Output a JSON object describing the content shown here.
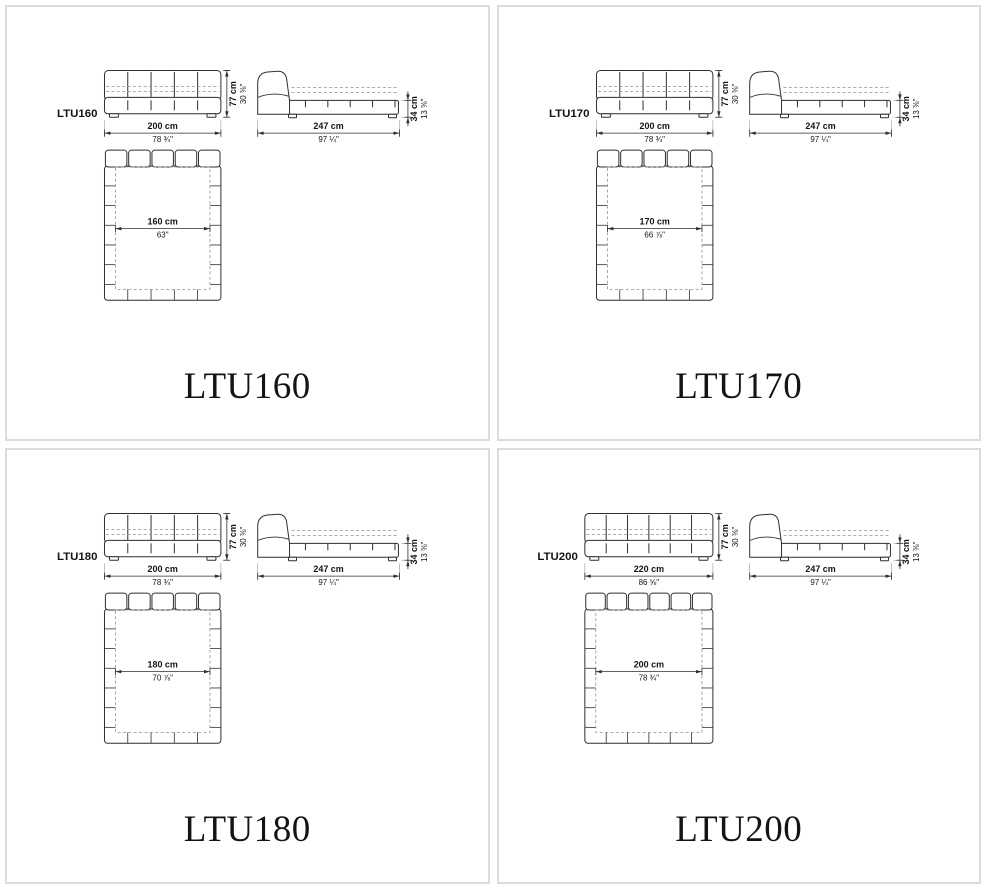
{
  "page": {
    "background": "#ffffff",
    "panel_border_color": "#dcdcdc",
    "line_color": "#2f2f2f",
    "dash_color": "#909090",
    "extension_color": "#9a9a9a",
    "text_color": "#141414"
  },
  "panels": [
    {
      "model": "LTU160",
      "title": "LTU160",
      "segments": 5,
      "front": {
        "width_cm": "200 cm",
        "width_in": "78 ¾\"",
        "height_cm": "77 cm",
        "height_in": "30 ⅜\""
      },
      "side": {
        "length_cm": "247 cm",
        "length_in": "97 ¼\"",
        "base_height_cm": "34 cm",
        "base_height_in": "13 ⅜\""
      },
      "plan": {
        "mattress_width_cm": "160 cm",
        "mattress_width_in": "63\""
      }
    },
    {
      "model": "LTU170",
      "title": "LTU170",
      "segments": 5,
      "front": {
        "width_cm": "200 cm",
        "width_in": "78 ¾\"",
        "height_cm": "77 cm",
        "height_in": "30 ⅜\""
      },
      "side": {
        "length_cm": "247 cm",
        "length_in": "97 ¼\"",
        "base_height_cm": "34 cm",
        "base_height_in": "13 ⅜\""
      },
      "plan": {
        "mattress_width_cm": "170 cm",
        "mattress_width_in": "66 ⅞\""
      }
    },
    {
      "model": "LTU180",
      "title": "LTU180",
      "segments": 5,
      "front": {
        "width_cm": "200 cm",
        "width_in": "78 ¾\"",
        "height_cm": "77 cm",
        "height_in": "30 ⅜\""
      },
      "side": {
        "length_cm": "247 cm",
        "length_in": "97 ¼\"",
        "base_height_cm": "34 cm",
        "base_height_in": "13 ⅜\""
      },
      "plan": {
        "mattress_width_cm": "180 cm",
        "mattress_width_in": "70 ⅞\""
      }
    },
    {
      "model": "LTU200",
      "title": "LTU200",
      "segments": 6,
      "front": {
        "width_cm": "220 cm",
        "width_in": "86 ⅝\"",
        "height_cm": "77 cm",
        "height_in": "30 ⅜\""
      },
      "side": {
        "length_cm": "247 cm",
        "length_in": "97 ¼\"",
        "base_height_cm": "34 cm",
        "base_height_in": "13 ⅜\""
      },
      "plan": {
        "mattress_width_cm": "200 cm",
        "mattress_width_in": "78 ¾\""
      }
    }
  ]
}
